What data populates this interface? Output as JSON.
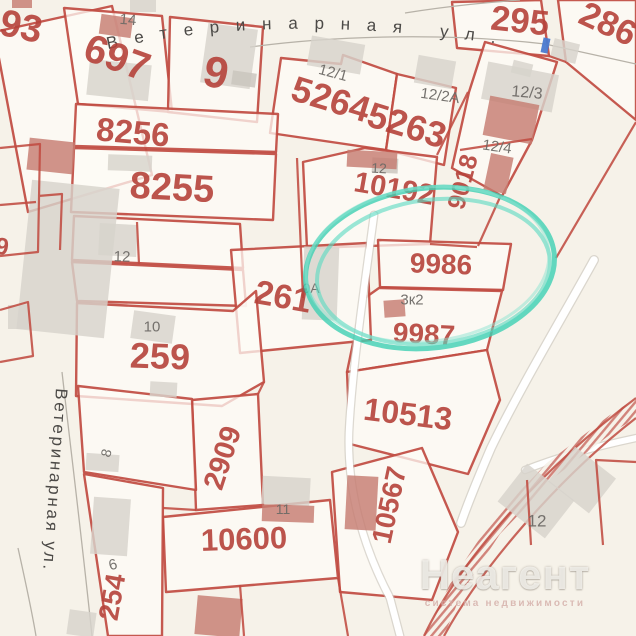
{
  "watermark": {
    "title": "Неагент",
    "subtitle": "система недвижимости"
  },
  "map": {
    "colors": {
      "bg": "#f6f2e9",
      "parcel": "#fdfbf6",
      "border": "#c04b41",
      "red_label": "#b5413a",
      "gray_label": "#6e6a66",
      "street": "#4c4a47",
      "bld_gray": "#d7d3cc",
      "bld_gray2": "#c9c4bd",
      "bld_red": "#c67d72",
      "bld_blue": "#4a7ad0",
      "road_casing": "#c8c3ba",
      "hatch": "#c14f46",
      "teal": "#3dcfb3"
    },
    "streets": {
      "top": {
        "text": "Ветеринарная ул.",
        "path": "M104,50 C210,26 330,20 500,44",
        "size": 17,
        "length": 390
      },
      "left": {
        "text": "Ветеринарная ул.",
        "x": 56,
        "y": 388,
        "rot": 94,
        "size": 17,
        "length": 182
      }
    },
    "parcels": [
      {
        "name": "93",
        "d": "M-6,32 L112,6 L152,175 L28,212 Z"
      },
      {
        "name": "697",
        "d": "M64,8 L162,16 L172,112 L78,104 Z"
      },
      {
        "name": "9",
        "d": "M170,17 L263,27 L257,122 L168,112 Z"
      },
      {
        "name": "5264",
        "d": "M281,58 L341,64 L343,55 L397,74 L386,150 L270,133 Z"
      },
      {
        "name": "5263",
        "d": "M397,74 L456,88 L444,165 L386,150 Z"
      },
      {
        "name": "295",
        "d": "M452,2 L541,0 L549,56 L457,48 Z"
      },
      {
        "name": "286",
        "d": "M558,0 L636,0 L636,120 L566,62 Z"
      },
      {
        "name": "12-3",
        "d": "M469,92 L485,42 L557,62 L532,140 L502,196 L452,168 Z"
      },
      {
        "name": "8256",
        "d": "M76,104 L278,114 L276,152 L74,146 Z"
      },
      {
        "name": "8255",
        "d": "M74,148 L276,154 L273,220 L71,212 Z"
      },
      {
        "name": "12-row",
        "d": "M74,216 L240,224 L243,268 L72,260 Z"
      },
      {
        "name": "10-row",
        "d": "M72,262 L243,270 L246,306 L77,301 Z"
      },
      {
        "name": "10192",
        "d": "M303,162 L365,148 L437,157 L430,244 L307,248 Z"
      },
      {
        "name": "9986",
        "d": "M378,240 L511,244 L503,290 L380,287 Z"
      },
      {
        "name": "9987",
        "d": "M379,288 L502,291 L487,350 L347,372 L362,300 Z"
      },
      {
        "name": "261",
        "d": "M231,250 L367,243 L371,340 L240,353 Z"
      },
      {
        "name": "259",
        "d": "M77,303 L233,311 L256,291 L264,382 L222,406 L76,396 Z"
      },
      {
        "name": "2909",
        "d": "M192,400 L258,394 L263,505 L196,510 Z"
      },
      {
        "name": "10513",
        "d": "M347,372 L487,350 L500,400 L468,474 L350,444 Z"
      },
      {
        "name": "10567",
        "d": "M332,472 L422,448 L458,532 L432,600 L340,592 Z"
      },
      {
        "name": "10600",
        "d": "M163,517 L330,500 L338,578 L166,592 Z"
      },
      {
        "name": "8-par",
        "d": "M78,386 L192,399 L196,490 L84,472 Z"
      },
      {
        "name": "6-254",
        "d": "M84,474 L163,488 L162,636 L108,636 Z"
      }
    ],
    "border_segments": [
      "M297,158 L303,298",
      "M137,222 L139,264",
      "M460,150 L532,139",
      "M437,155 L468,92",
      "M501,195 L478,246",
      "M430,244 L477,247",
      "M636,122 L556,258",
      "M549,56 L566,62",
      "M0,148 L40,144 L38,252 L0,256 M38,196 L62,194 L60,250 M0,205 L36,202",
      "M0,310 L28,302 L33,356 L0,362",
      "M163,508 L196,510",
      "M258,394 L264,382",
      "M338,578 L348,636",
      "M240,585 L244,636",
      "M636,462 L596,460 L603,545",
      "M527,480 L531,545"
    ],
    "street_lines": [
      "M250,47 C340,35 450,33 545,44 L636,64",
      "M405,13 C455,5 495,2 520,0",
      "M62,372 C72,460 82,540 92,636",
      "M18,548 C26,584 32,612 36,636"
    ],
    "roads": [
      {
        "d": "M374,215 C364,290 352,370 349,432 C347,488 362,545 390,598 L400,636",
        "w": 6.5
      },
      {
        "d": "M594,260 C562,318 520,388 491,448 C479,476 469,500 461,523",
        "w": 7.5
      },
      {
        "d": "M525,470 C560,456 598,446 636,438",
        "w": 6
      }
    ],
    "hatch_road": {
      "band": "M424,636 L452,580 L492,520 L548,462 L610,415 L636,398 L636,418 L616,430 L556,476 L500,534 L462,592 L444,636 Z",
      "edges": [
        "M424,636 C460,560 540,470 636,398",
        "M444,636 C480,570 556,480 636,418"
      ]
    },
    "buildings": [
      [
        24,
        184,
        88,
        150,
        6,
        "gray"
      ],
      [
        88,
        62,
        62,
        36,
        6,
        "gray"
      ],
      [
        130,
        0,
        26,
        12,
        0,
        "gray"
      ],
      [
        204,
        26,
        50,
        60,
        8,
        "gray"
      ],
      [
        232,
        72,
        24,
        14,
        8,
        "gray2"
      ],
      [
        309,
        40,
        54,
        30,
        10,
        "gray"
      ],
      [
        416,
        58,
        38,
        28,
        10,
        "gray"
      ],
      [
        552,
        41,
        26,
        20,
        14,
        "gray"
      ],
      [
        512,
        62,
        20,
        13,
        14,
        "gray"
      ],
      [
        484,
        68,
        72,
        38,
        11,
        "gray"
      ],
      [
        108,
        155,
        44,
        16,
        2,
        "gray"
      ],
      [
        99,
        224,
        38,
        32,
        3,
        "gray"
      ],
      [
        132,
        313,
        42,
        28,
        8,
        "gray"
      ],
      [
        150,
        382,
        27,
        15,
        3,
        "gray"
      ],
      [
        8,
        305,
        22,
        24,
        0,
        "gray"
      ],
      [
        303,
        247,
        35,
        73,
        2,
        "gray"
      ],
      [
        86,
        454,
        33,
        17,
        4,
        "gray"
      ],
      [
        92,
        498,
        37,
        57,
        4,
        "gray"
      ],
      [
        262,
        477,
        48,
        28,
        3,
        "gray"
      ],
      [
        68,
        611,
        27,
        25,
        8,
        "gray"
      ],
      [
        506,
        477,
        60,
        48,
        38,
        "gray"
      ],
      [
        556,
        458,
        52,
        44,
        38,
        "gray"
      ],
      [
        372,
        158,
        26,
        15,
        3,
        "gray2"
      ],
      [
        28,
        140,
        46,
        32,
        6,
        "red"
      ],
      [
        100,
        16,
        32,
        20,
        8,
        "red"
      ],
      [
        486,
        100,
        50,
        40,
        11,
        "red"
      ],
      [
        487,
        155,
        23,
        37,
        12,
        "red"
      ],
      [
        347,
        151,
        50,
        17,
        3,
        "red"
      ],
      [
        384,
        300,
        21,
        17,
        -4,
        "red"
      ],
      [
        262,
        505,
        52,
        17,
        2,
        "red"
      ],
      [
        346,
        476,
        31,
        54,
        3,
        "red"
      ],
      [
        196,
        597,
        45,
        39,
        5,
        "red"
      ],
      [
        12,
        0,
        20,
        8,
        0,
        "red"
      ],
      [
        542,
        38,
        7,
        15,
        12,
        "blue"
      ]
    ],
    "labels": [
      {
        "t": "93",
        "x": 21,
        "y": 27,
        "s": 38,
        "r": 12,
        "c": "red"
      },
      {
        "t": "697",
        "x": 117,
        "y": 58,
        "s": 40,
        "r": 20,
        "c": "red"
      },
      {
        "t": "9",
        "x": 216,
        "y": 73,
        "s": 44,
        "r": 12,
        "c": "red"
      },
      {
        "t": "8256",
        "x": 133,
        "y": 132,
        "s": 33,
        "r": 5,
        "c": "red"
      },
      {
        "t": "8255",
        "x": 172,
        "y": 188,
        "s": 38,
        "r": 3,
        "c": "red"
      },
      {
        "t": "5264",
        "x": 331,
        "y": 99,
        "s": 36,
        "r": 17,
        "c": "red"
      },
      {
        "t": "5263",
        "x": 407,
        "y": 125,
        "s": 36,
        "r": 17,
        "c": "red"
      },
      {
        "t": "295",
        "x": 520,
        "y": 21,
        "s": 35,
        "r": 6,
        "c": "red"
      },
      {
        "t": "286",
        "x": 608,
        "y": 24,
        "s": 35,
        "r": 25,
        "c": "red"
      },
      {
        "t": "10192",
        "x": 394,
        "y": 189,
        "s": 29,
        "r": 10,
        "c": "red"
      },
      {
        "t": "9018",
        "x": 463,
        "y": 182,
        "s": 25,
        "r": -75,
        "c": "red"
      },
      {
        "t": "9986",
        "x": 441,
        "y": 264,
        "s": 28,
        "r": 2,
        "c": "red"
      },
      {
        "t": "9987",
        "x": 424,
        "y": 334,
        "s": 28,
        "r": 3,
        "c": "red"
      },
      {
        "t": "261",
        "x": 283,
        "y": 297,
        "s": 34,
        "r": 10,
        "c": "red"
      },
      {
        "t": "259",
        "x": 160,
        "y": 356,
        "s": 36,
        "r": 2,
        "c": "red"
      },
      {
        "t": "2909",
        "x": 223,
        "y": 458,
        "s": 29,
        "r": -72,
        "c": "red"
      },
      {
        "t": "10513",
        "x": 408,
        "y": 414,
        "s": 32,
        "r": 7,
        "c": "red"
      },
      {
        "t": "10600",
        "x": 244,
        "y": 539,
        "s": 31,
        "r": -2,
        "c": "red"
      },
      {
        "t": "10567",
        "x": 389,
        "y": 505,
        "s": 28,
        "r": -78,
        "c": "red"
      },
      {
        "t": "254",
        "x": 112,
        "y": 597,
        "s": 28,
        "r": -80,
        "c": "red"
      },
      {
        "t": "9",
        "x": 2,
        "y": 247,
        "s": 24,
        "r": 8,
        "c": "red"
      },
      {
        "t": "14",
        "x": 128,
        "y": 20,
        "s": 15,
        "r": 5,
        "c": "gray"
      },
      {
        "t": "12/1",
        "x": 333,
        "y": 73,
        "s": 15,
        "r": 15,
        "c": "gray"
      },
      {
        "t": "12/2А",
        "x": 440,
        "y": 96,
        "s": 15,
        "r": 8,
        "c": "gray"
      },
      {
        "t": "12/3",
        "x": 527,
        "y": 93,
        "s": 16,
        "r": 5,
        "c": "gray"
      },
      {
        "t": "12/4",
        "x": 497,
        "y": 147,
        "s": 15,
        "r": 8,
        "c": "gray"
      },
      {
        "t": "12",
        "x": 379,
        "y": 168,
        "s": 14,
        "r": 3,
        "c": "gray"
      },
      {
        "t": "12",
        "x": 122,
        "y": 257,
        "s": 15,
        "r": 2,
        "c": "gray"
      },
      {
        "t": "10",
        "x": 152,
        "y": 327,
        "s": 15,
        "r": 0,
        "c": "gray"
      },
      {
        "t": "0А",
        "x": 311,
        "y": 288,
        "s": 14,
        "r": 0,
        "c": "gray"
      },
      {
        "t": "3к2",
        "x": 412,
        "y": 300,
        "s": 15,
        "r": 0,
        "c": "gray"
      },
      {
        "t": "8",
        "x": 106,
        "y": 453,
        "s": 14,
        "r": -75,
        "c": "gray"
      },
      {
        "t": "6",
        "x": 113,
        "y": 565,
        "s": 15,
        "r": -15,
        "c": "gray"
      },
      {
        "t": "11",
        "x": 283,
        "y": 509,
        "s": 14,
        "r": 0,
        "c": "gray"
      },
      {
        "t": "12",
        "x": 537,
        "y": 521,
        "s": 17,
        "r": 0,
        "c": "gray"
      }
    ],
    "circle": {
      "cx": 430,
      "cy": 268,
      "rot": -7,
      "highlighted_parcel": "9986",
      "rings": [
        [
          430,
          268,
          125,
          80,
          5,
          "#3dcfb3",
          0.8
        ],
        [
          433,
          272,
          117,
          72,
          4,
          "#5cdac2",
          0.62
        ],
        [
          428,
          264,
          122,
          77,
          3,
          "#8ce4d2",
          0.5
        ]
      ]
    }
  }
}
